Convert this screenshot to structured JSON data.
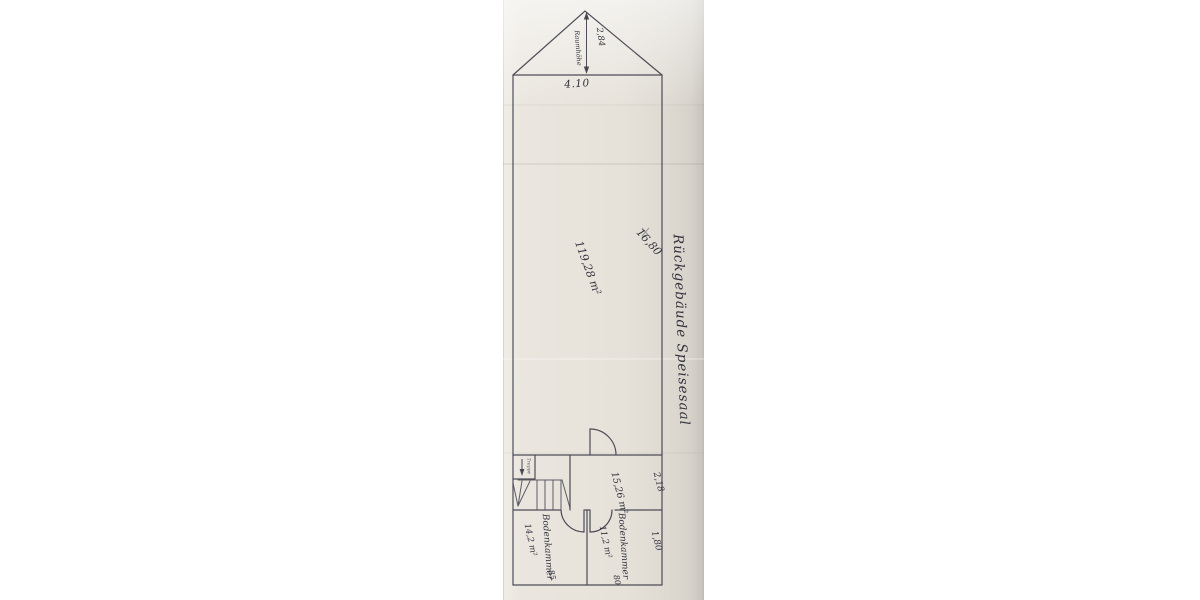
{
  "plan": {
    "gable": {
      "ridge_height_dim": "2,84",
      "ridge_height_label": "Raumhöhe",
      "base_dim": "4.10"
    },
    "hall": {
      "length_dim": "16,80",
      "area": "119,28 m²"
    },
    "margin_note": "Rückgebäude Speisesaal",
    "mid_room": {
      "area": "15,26 m²",
      "depth_dim": "2,18"
    },
    "stairs": {
      "label": "Treppe"
    },
    "left_room": {
      "name": "Bodenkammer",
      "area": "14,2 m²",
      "door_width": "85"
    },
    "right_room": {
      "name": "Bodenkammer",
      "area": "11,2 m²",
      "door_width": "80"
    },
    "bottom_dim": "1,80"
  },
  "colors": {
    "paper": "#e8e4dc",
    "ink": "#383844",
    "pencil": "#4a4a52"
  }
}
